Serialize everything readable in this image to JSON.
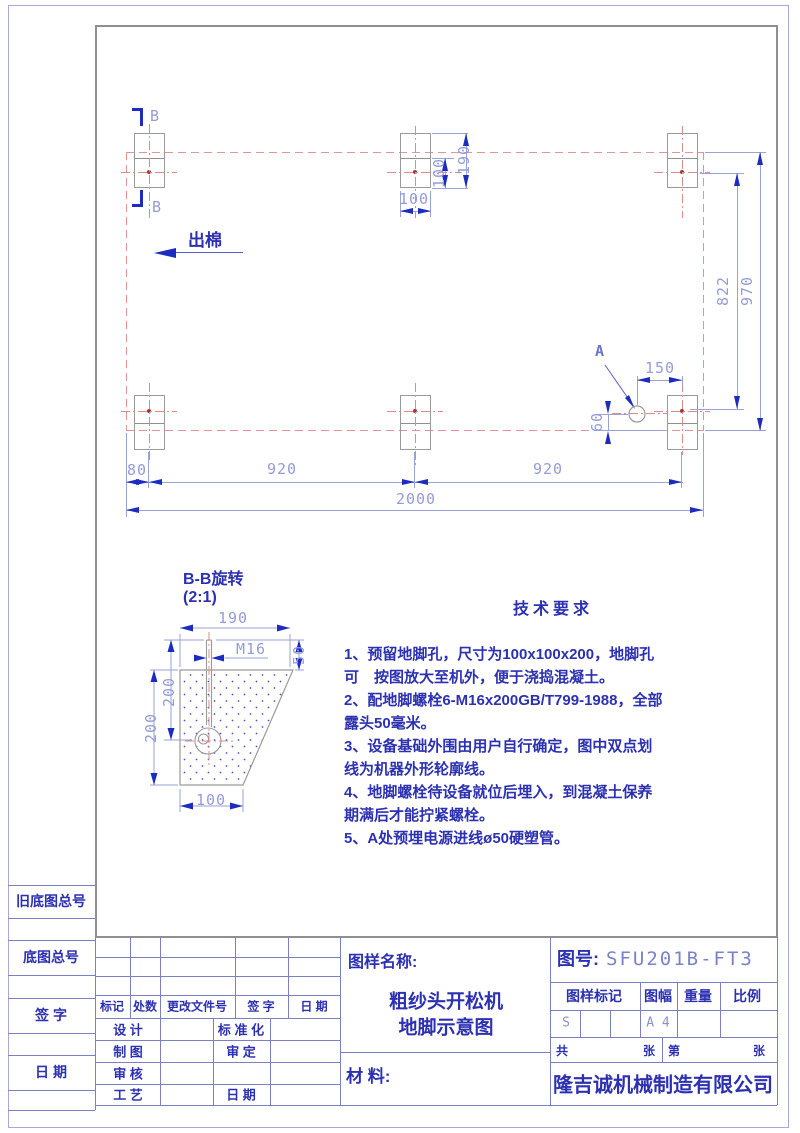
{
  "colors": {
    "line_blue": "#2c31b2",
    "dim_blue": "#949cd8",
    "arrow_blue": "#1d2cc0",
    "centerline_red": "#dd8c8c",
    "frame_gray": "#8f8f8f",
    "border_purple": "#a8aadd"
  },
  "plan": {
    "section_label": "B",
    "outflow_label": "出棉",
    "a_label": "A",
    "dims": {
      "block_width": "100",
      "block_height": "190",
      "block_inner": "100",
      "edge": "80",
      "pitch_left": "920",
      "pitch_right": "920",
      "overall": "2000",
      "row_span_inner": "822",
      "row_span_outer": "970",
      "a_offset_x": "150",
      "a_offset_y": "60"
    }
  },
  "detail": {
    "title": "B-B旋转",
    "scale": "(2:1)",
    "top_width": "190",
    "bolt_spec": "M16",
    "protrusion": "50",
    "depth_outer": "200",
    "bolt_embed": "200",
    "bottom_width": "100"
  },
  "tech": {
    "title": "技术要求",
    "lines": [
      "1、预留地脚孔，尺寸为100x100x200，地脚孔",
      "可　按图放大至机外，便于浇捣混凝土。",
      "2、配地脚螺栓6-M16x200GB/T799-1988，全部",
      "露头50毫米。",
      "3、设备基础外围由用户自行确定，图中双点划",
      "线为机器外形轮廓线。",
      "4、地脚螺栓待设备就位后埋入，到混凝土保养",
      "期满后才能拧紧螺栓。",
      "5、A处预埋电源进线ø50硬塑管。"
    ]
  },
  "left_strip": {
    "labels": [
      "旧底图总号",
      "底图总号",
      "签 字",
      "日 期"
    ]
  },
  "rev_table": {
    "headers": [
      "标记",
      "处数",
      "更改文件号",
      "签  字",
      "日 期"
    ],
    "rows": [
      {
        "left": "设 计",
        "right": "标 准 化"
      },
      {
        "left": "制 图",
        "right": "审 定"
      },
      {
        "left": "审 核",
        "right": ""
      },
      {
        "left": "工 艺",
        "right": "日  期"
      }
    ]
  },
  "title_block": {
    "name_label": "图样名称:",
    "product_name": "粗纱头开松机",
    "drawing_name": "地脚示意图",
    "material_label": "材 料:",
    "drawing_no_label": "图号:",
    "drawing_no": "SFU201B-FT3",
    "col_headers": [
      "图样标记",
      "图幅",
      "重量",
      "比例"
    ],
    "mark_value": "S",
    "sheet_size": "A 4",
    "sheets_total_label": "共",
    "sheets_sheet1": "张",
    "sheets_no_label": "第",
    "sheets_sheet2": "张",
    "company": "隆吉诚机械制造有限公司"
  }
}
